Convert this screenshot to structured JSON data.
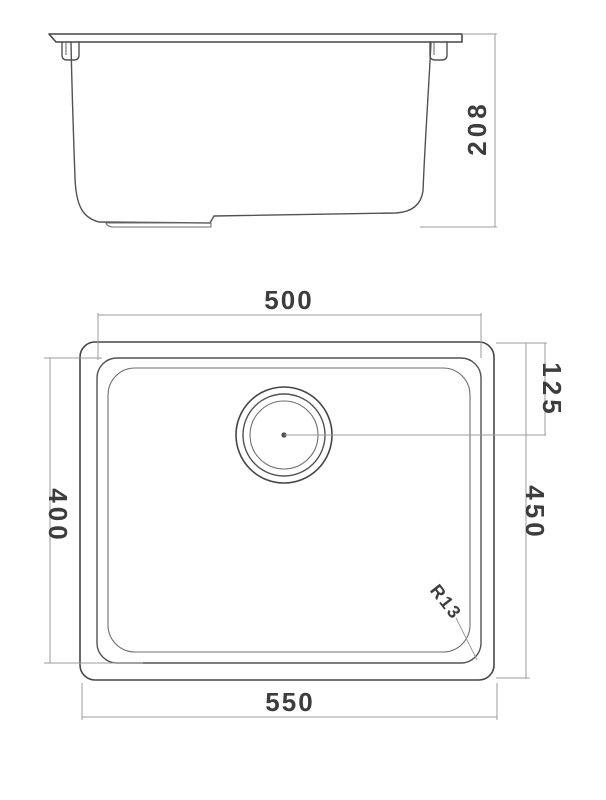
{
  "drawing": {
    "colors": {
      "background": "#ffffff",
      "geometry_line": "#525252",
      "dimension_line": "#9b9b9b",
      "label_text": "#3d3d3d"
    },
    "side_view": {
      "dimensions": {
        "overall_height": {
          "label": "208",
          "orientation": "vertical"
        }
      }
    },
    "plan_view": {
      "dimensions": {
        "bowl_width": {
          "label": "500",
          "orientation": "horizontal"
        },
        "overall_width": {
          "label": "550",
          "orientation": "horizontal"
        },
        "bowl_depth": {
          "label": "400",
          "orientation": "vertical"
        },
        "overall_depth": {
          "label": "450",
          "orientation": "vertical"
        },
        "drain_offset": {
          "label": "125",
          "orientation": "vertical"
        },
        "corner_radius": {
          "label": "R13",
          "orientation": "diagonal"
        }
      }
    }
  }
}
